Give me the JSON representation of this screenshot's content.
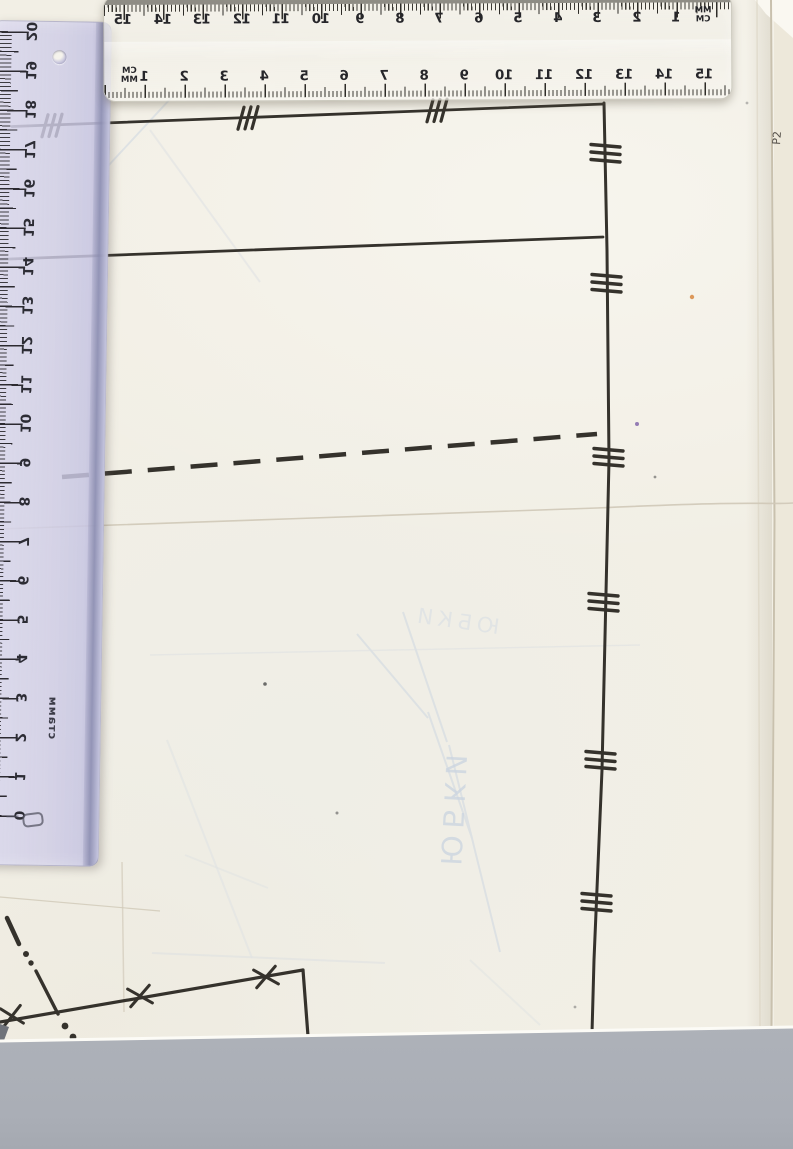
{
  "rulers": {
    "horizontal_top": {
      "mirrored": true,
      "upper_scale_numbers": [
        "15",
        "14",
        "13",
        "12",
        "11",
        "10",
        "9",
        "8",
        "7",
        "6",
        "5",
        "4",
        "3",
        "2",
        "1"
      ],
      "upper_label_top": "MM",
      "upper_label_bottom": "CM",
      "lower_scale_numbers": [
        "1",
        "2",
        "3",
        "4",
        "5",
        "6",
        "7",
        "8",
        "9",
        "10",
        "11",
        "12",
        "13",
        "14",
        "15"
      ],
      "lower_label_top": "CM",
      "lower_label_bottom": "MM"
    },
    "vertical_left": {
      "mirrored": true,
      "numbers": [
        "20",
        "19",
        "18",
        "17",
        "16",
        "15",
        "14",
        "13",
        "12",
        "11",
        "10",
        "9",
        "8",
        "7",
        "6",
        "5",
        "4",
        "3",
        "2",
        "1",
        "0"
      ],
      "brand": "стамм"
    }
  },
  "pattern_sheet": {
    "bleed_word_vertical": "ЮБКИ",
    "bleed_word_diagonal": "ЮБКИ",
    "edge_mark": "Р2"
  },
  "colors": {
    "paper": "#f2efe5",
    "scanner_background": "#b3b6bc",
    "ruler_lavender": "#d3d1e7",
    "ink": "#35322c"
  }
}
